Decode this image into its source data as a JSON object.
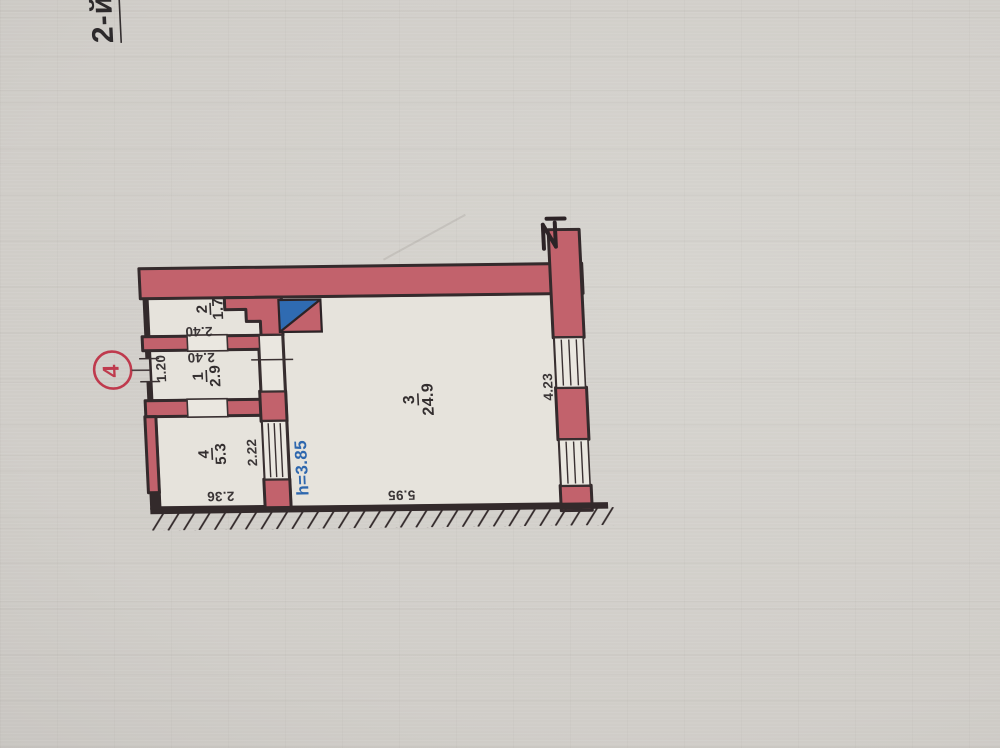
{
  "floor_label": "2-й",
  "apartment_badge": "4",
  "rooms": [
    {
      "number": "1",
      "area": "2.9"
    },
    {
      "number": "2",
      "area": "1.7"
    },
    {
      "number": "3",
      "area": "24.9"
    },
    {
      "number": "4",
      "area": "5.3"
    }
  ],
  "dimensions": {
    "room1_depth": "1.20",
    "room1_width": "2.40",
    "room2_width": "2.40",
    "room4_depth": "2.22",
    "room4_width": "2.36",
    "room3_depth": "4.23",
    "room3_width": "5.95"
  },
  "notes": {
    "ceiling_height": "h=3.85"
  },
  "colors": {
    "wall_fill": "#c2626c",
    "outline_ink": "#342a2c",
    "vent_blue": "#2f6bb2",
    "height_note_blue": "#2e67ae",
    "badge_red": "#bf3a4d",
    "text_ink": "#332e2f",
    "paper": "#cfccc7"
  }
}
